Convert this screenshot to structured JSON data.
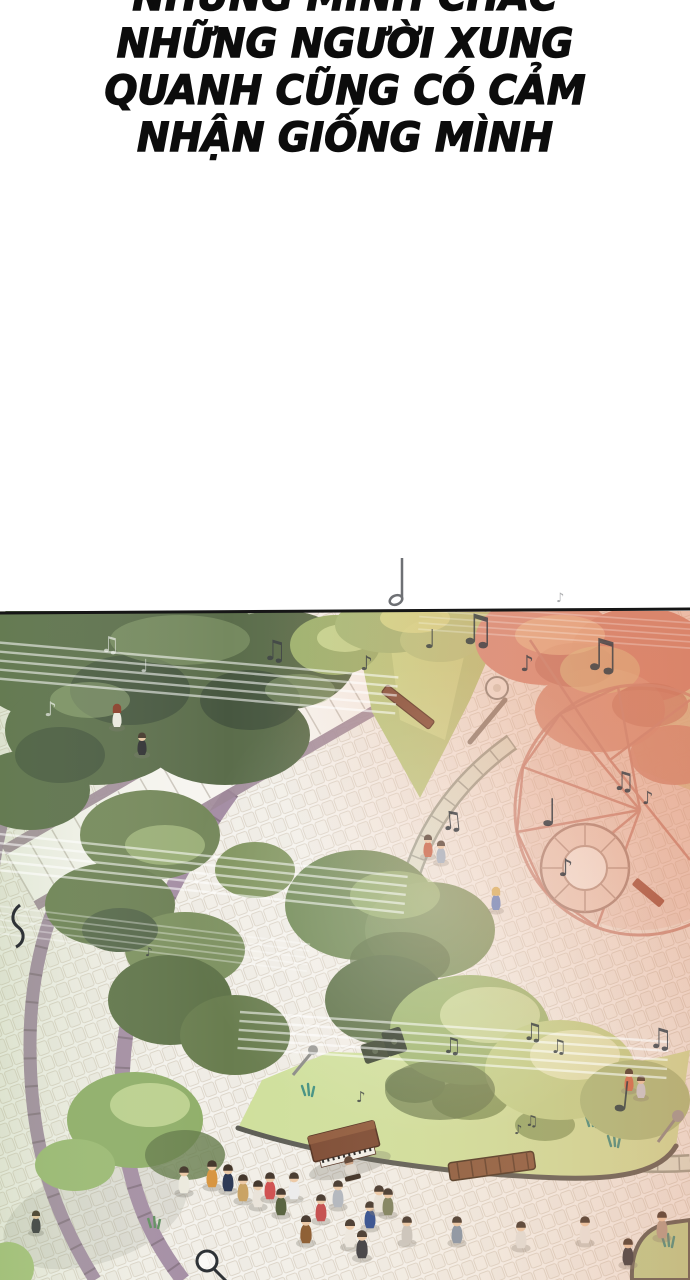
{
  "page": {
    "width": 690,
    "height": 1280,
    "background": "#ffffff",
    "kind": "webtoon-panel"
  },
  "narration": {
    "color": "#0c0c0c",
    "lines": [
      "NHƯNG MÌNH CHẮC",
      "NHỮNG NGƯỜI XUNG",
      "QUANH CŨNG CÓ CẢM",
      "NHẬN GIỐNG MÌNH"
    ]
  },
  "panel": {
    "alt": "Aerial view of a park plaza: a pianist at a street piano plays for a crowd; music notes and staff lines drift over trees, winding paths and a pink pavilion",
    "border_color": "#161616",
    "palette": {
      "tree_dark": "#5b6d4b",
      "tree_mid": "#7e9660",
      "tree_light": "#cfe0a0",
      "grass": "#b9cc82",
      "cobble": "#f5f3ee",
      "path_mauve": "#a48da4",
      "seatwall_green": "#dee4d2",
      "pavilion_pink": "#c6867a",
      "stairs_red": "#a1584a",
      "piano_brown": "#7c4a32",
      "note_gray": "#3f4247",
      "sunset_wash": "#e08a66",
      "skin": "#ecc9a6"
    }
  },
  "icons": {
    "beamed_notes": "♫",
    "eighth_note": "♪",
    "quarter_note": "♩"
  }
}
